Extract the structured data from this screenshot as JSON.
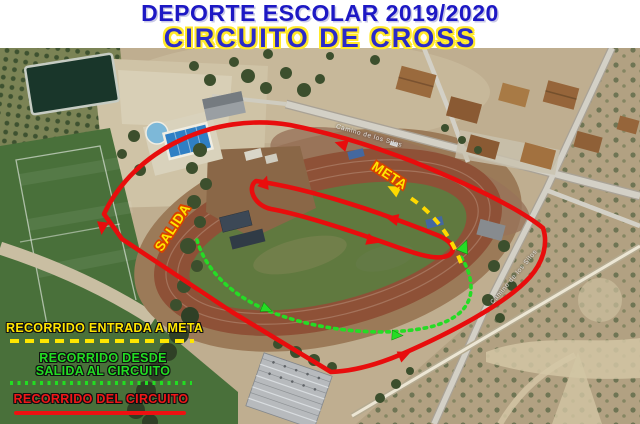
{
  "header": {
    "title_line1": "DEPORTE ESCOLAR 2019/2020",
    "title_line2": "CIRCUITO DE CROSS"
  },
  "map": {
    "type": "aerial-photo",
    "route_labels": {
      "meta": "META",
      "salida": "SALIDA"
    },
    "street_labels": {
      "top_road": "Camino de los Silos",
      "right_road": "Camino de los Silos"
    },
    "visible_features": [
      "running-track",
      "football-field",
      "swimming-pools",
      "pond",
      "orchard",
      "houses",
      "warehouse",
      "scrubland",
      "roads"
    ]
  },
  "legend": {
    "items": [
      {
        "id": "entrada-meta",
        "label": "RECORRIDO ENTRADA A META",
        "color": "#ffe600",
        "line_style": "dashed"
      },
      {
        "id": "salida-circuito",
        "label_line1": "RECORRIDO DESDE",
        "label_line2": "SALIDA AL CIRCUITO",
        "color": "#22dd22",
        "line_style": "dotted"
      },
      {
        "id": "circuito",
        "label": "RECORRIDO DEL CIRCUITO",
        "color": "#ee1111",
        "line_style": "solid"
      }
    ]
  },
  "colors": {
    "title_blue": "#1d18c4",
    "title_outline_yellow": "#ffe92a",
    "route_red": "#e80d0d",
    "route_yellow": "#ffd900",
    "route_green": "#25dc25",
    "label_yellow": "#ffe600",
    "label_outline_red": "#d84300"
  }
}
